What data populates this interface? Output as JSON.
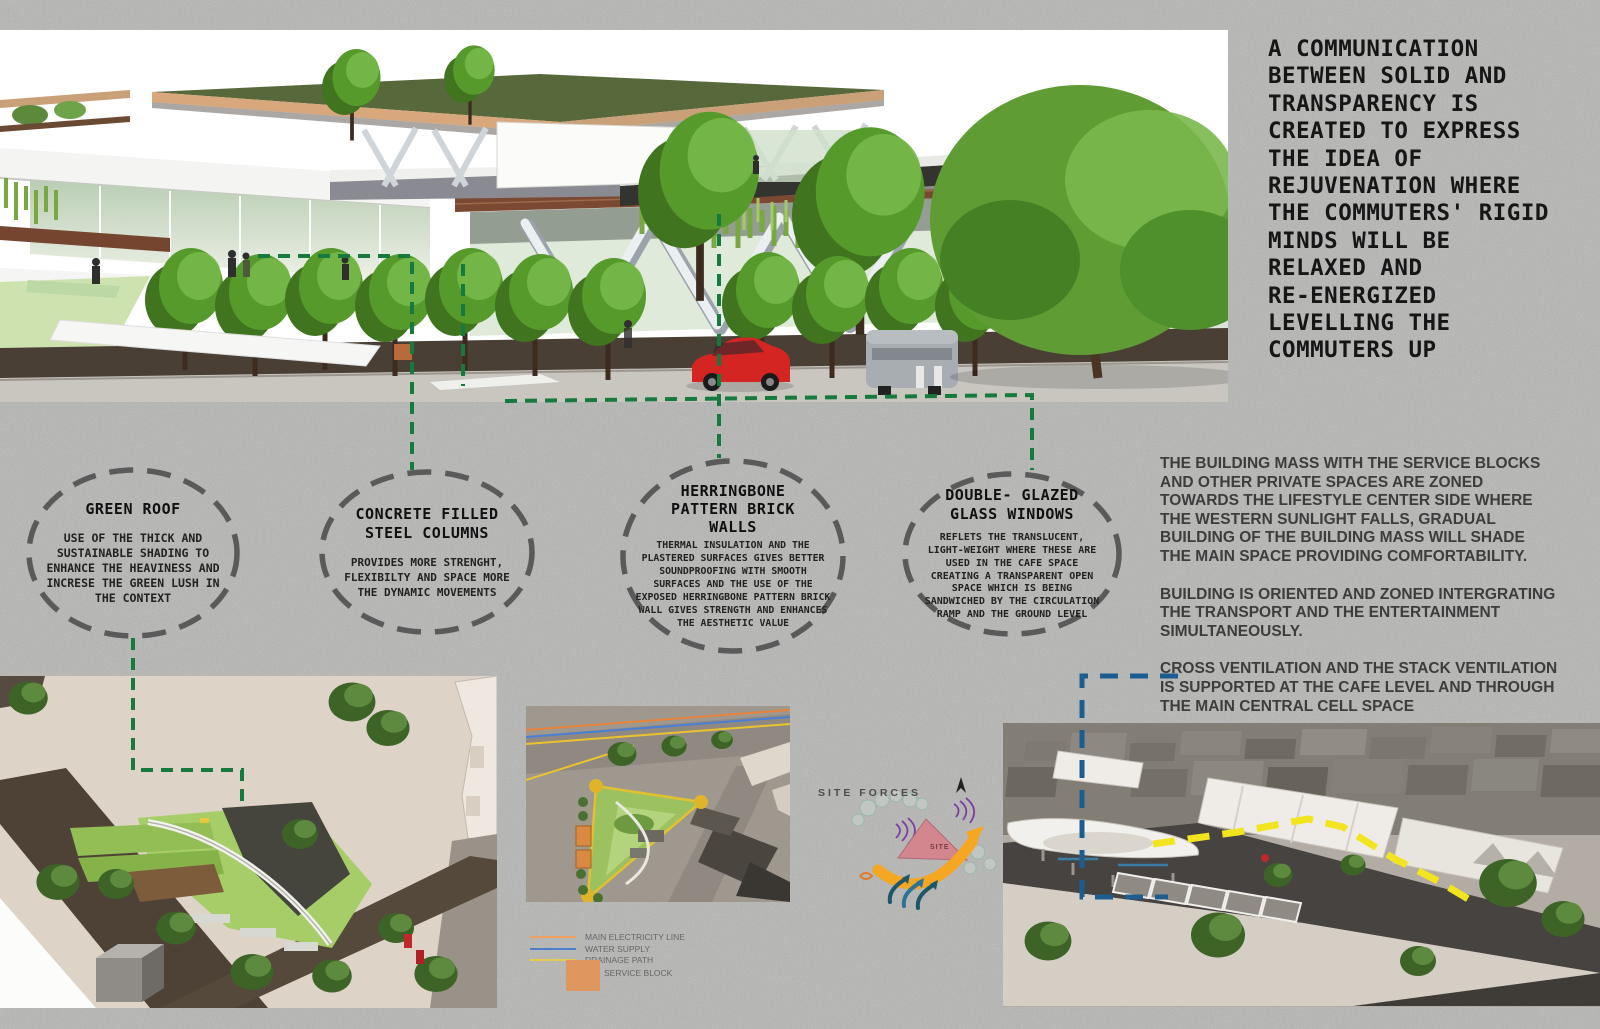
{
  "statement": "A COMMUNICATION\nBETWEEN SOLID AND\nTRANSPARENCY IS\nCREATED TO EXPRESS\nTHE IDEA OF\nREJUVENATION WHERE\nTHE COMMUTERS' RIGID\nMINDS WILL BE\nRELAXED AND\nRE-ENERGIZED\nLEVELLING THE\nCOMMUTERS UP",
  "callouts": [
    {
      "title": "GREEN ROOF",
      "body": "USE OF THE THICK AND SUSTAINABLE SHADING TO ENHANCE THE HEAVINESS AND INCRESE THE GREEN LUSH IN THE CONTEXT"
    },
    {
      "title": "CONCRETE FILLED STEEL COLUMNS",
      "body": "PROVIDES MORE STRENGHT, FLEXIBILTY AND SPACE MORE THE DYNAMIC MOVEMENTS"
    },
    {
      "title": "HERRINGBONE PATTERN BRICK WALLS",
      "body": "THERMAL INSULATION AND THE PLASTERED SURFACES GIVES BETTER SOUNDPROOFING WITH SMOOTH SURFACES AND THE USE OF THE EXPOSED HERRINGBONE PATTERN BRICK WALL GIVES STRENGTH AND ENHANCES THE AESTHETIC VALUE"
    },
    {
      "title": "DOUBLE- GLAZED GLASS WINDOWS",
      "body": "REFLETS THE TRANSLUCENT, LIGHT-WEIGHT WHERE THESE ARE USED IN THE CAFE SPACE CREATING A TRANSPARENT OPEN SPACE WHICH IS BEING SANDWICHED BY THE CIRCULATION RAMP AND THE GROUND LEVEL"
    }
  ],
  "paragraphs": [
    "THE BUILDING MASS WITH THE SERVICE BLOCKS AND OTHER PRIVATE SPACES ARE ZONED TOWARDS THE LIFESTYLE CENTER SIDE WHERE THE WESTERN SUNLIGHT FALLS, GRADUAL BUILDING OF THE BUILDING MASS WILL SHADE THE MAIN SPACE PROVIDING COMFORTABILITY.",
    "BUILDING IS ORIENTED AND ZONED INTERGRATING THE TRANSPORT AND THE ENTERTAINMENT SIMULTANEOUSLY.",
    "CROSS VENTILATION AND THE STACK VENTILATION IS SUPPORTED AT THE CAFE LEVEL AND THROUGH THE MAIN CENTRAL CELL SPACE"
  ],
  "site_forces": {
    "label": "SITE FORCES",
    "site_label": "SITE"
  },
  "legend": {
    "items": [
      {
        "label": "MAIN ELECTRICITY LINE",
        "color": "#f0a060"
      },
      {
        "label": "WATER SUPPLY",
        "color": "#4a7fc9"
      },
      {
        "label": "DRAINAGE PATH",
        "color": "#e9c94a"
      },
      {
        "label": "SERVICE BLOCK",
        "color": "#e0965f"
      }
    ]
  },
  "colors": {
    "background": "#b6b6b4",
    "callout_dash": "#5a5a5a",
    "annotation_green": "#167a3e",
    "annotation_blue": "#1d5c8f",
    "annotation_yellow": "#f2e41f",
    "brick": "#7b4832",
    "roof_green": "#57683b",
    "site_triangle_pink": "#d4868f",
    "sun_arrow_orange": "#f5a623"
  }
}
